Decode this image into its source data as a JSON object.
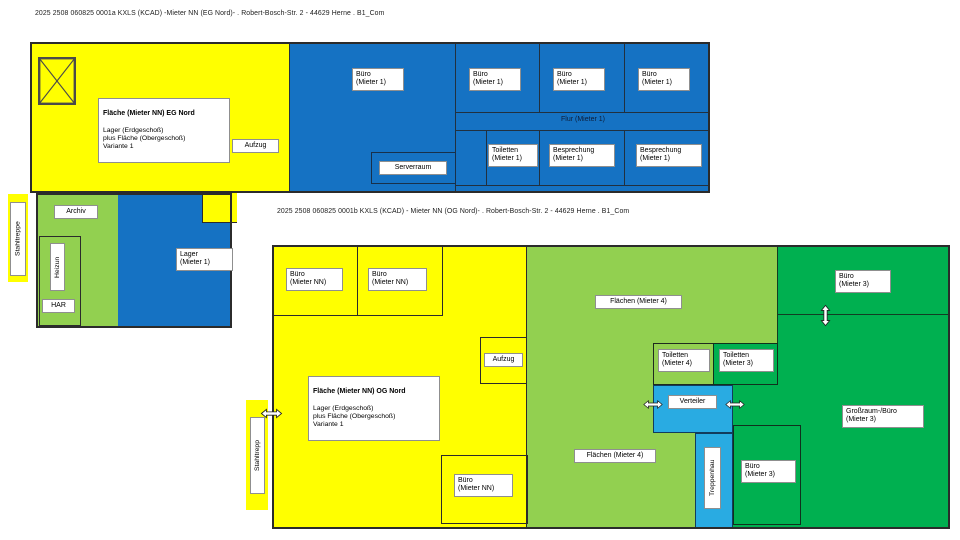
{
  "colors": {
    "page_bg": "#FFFFFF",
    "yellow": "#FFFF00",
    "blue": "#1572C3",
    "light_green": "#92D050",
    "dark_green": "#00B050",
    "cyan": "#29ABE2"
  },
  "plan_eg": {
    "title": "2025 2508 060825 0001a KXLS (KCAD) -Mieter NN (EG Nord)- . Robert-Bosch-Str. 2 - 44629 Herne . B1_Com",
    "info_box": {
      "heading": "Fläche (Mieter NN) EG Nord",
      "lines": "Lager (Erdgeschoß)\nplus Fläche (Obergeschoß)\nVariante 1"
    },
    "labels": {
      "stahltreppe": "Stahltreppe",
      "aufzug": "Aufzug",
      "buero_gross": "Büro\n(Mieter 1)",
      "buero_2": "Büro\n(Mieter 1)",
      "buero_3": "Büro\n(Mieter 1)",
      "buero_4": "Büro\n(Mieter 1)",
      "flur": "Flur (Mieter 1)",
      "serverraum": "Serverraum",
      "toiletten": "Toiletten\n(Mieter 1)",
      "besprechung_1": "Besprechung\n(Mieter 1)",
      "besprechung_2": "Besprechung\n(Mieter 1)",
      "archiv": "Archiv",
      "heizung": "Heizun",
      "har": "HAR",
      "lager": "Lager\n(Mieter 1)"
    }
  },
  "plan_og": {
    "title": "2025 2508 060825 0001b KXLS (KCAD) - Mieter NN (OG Nord)- . Robert-Bosch-Str. 2 - 44629 Herne . B1_Com",
    "info_box": {
      "heading": "Fläche (Mieter NN) OG Nord",
      "lines": "Lager (Erdgeschoß)\nplus Fläche (Obergeschoß)\nVariante 1"
    },
    "labels": {
      "buero_nn_1": "Büro\n(Mieter NN)",
      "buero_nn_2": "Büro\n(Mieter NN)",
      "aufzug": "Aufzug",
      "stahltreppe": "Stahltrepp",
      "buero_nn_3": "Büro\n(Mieter NN)",
      "flaechen_oben": "Flächen (Mieter 4)",
      "flaechen_unten": "Flächen (Mieter 4)",
      "toiletten_m4": "Toiletten\n(Mieter 4)",
      "toiletten_m3": "Toiletten\n(Mieter 3)",
      "verteiler": "Verteiler",
      "treppenhaus": "Treppenhau",
      "buero_m3_oben": "Büro\n(Mieter 3)",
      "grossraum": "Großraum-/Büro\n(Mieter 3)",
      "buero_m3_unten": "Büro\n(Mieter 3)"
    }
  }
}
